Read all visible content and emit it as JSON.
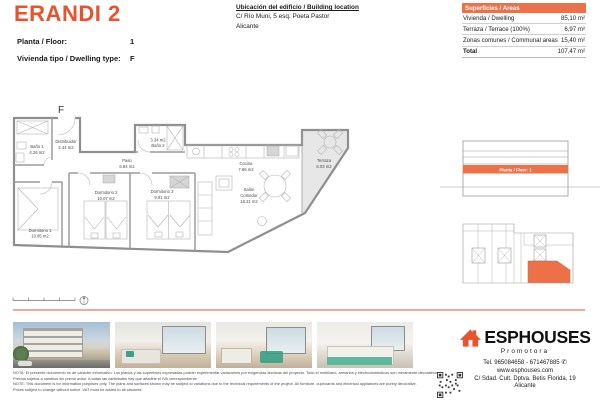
{
  "colors": {
    "accent": "#E8532D",
    "accent_mid": "#ED7148"
  },
  "header": {
    "title": "ERANDI 2",
    "meta": [
      {
        "label": "Planta / Floor:",
        "value": "1"
      },
      {
        "label": "Vivienda tipo / Dwelling type:",
        "value": "F"
      }
    ],
    "location": {
      "title": "Ubicación del edificio / Building location",
      "address": "C/ Río Muni, 5 esq. Poeta Pastor",
      "city": "Alicante"
    },
    "areas": {
      "title": "Superficies / Areas",
      "rows": [
        {
          "label": "Vivienda / Dwelling",
          "value": "85,10 m²"
        },
        {
          "label": "Terraza / Terrace (100%)",
          "value": "6,97 m²"
        },
        {
          "label": "Zonas comunes / Communal areas",
          "value": "15,40 m²"
        }
      ],
      "total": {
        "label": "Total",
        "value": "107,47 m²"
      }
    }
  },
  "plan": {
    "type_label": "F",
    "elevation_floor_label": "Planta / Floor: 1",
    "rooms": [
      {
        "line1": "Baño 1",
        "line2": "4.26 m2"
      },
      {
        "line1": "Distribuidor",
        "line2": "2.44 m2"
      },
      {
        "line1": "Paso",
        "line2": "6.84 m2"
      },
      {
        "line1": "3.34 m2",
        "line2": "Baño 2"
      },
      {
        "line1": "Cocina",
        "line2": "7.86 m2"
      },
      {
        "line1": "Salón",
        "line2": "Comedor",
        "line3": "16.21 m2"
      },
      {
        "line1": "Terraza",
        "line2": "6.03 m2"
      },
      {
        "line1": "Dormitorio 2",
        "line2": "10.07 m2"
      },
      {
        "line1": "Dormitorio 3",
        "line2": "9.91 m2"
      },
      {
        "line1": "Dormitorio 1",
        "line2": "10.85 m2"
      }
    ]
  },
  "footer": {
    "disclaimer": [
      "NOTA: El presente documento es de carácter informativo. Los planos y las superficies expresadas podrán experimentar variaciones por exigencias técnicas del proyecto. Todo el mobiliario, armarios y electrodomésticos son meramente decorativos.",
      "Precios sujetos a cambios sin previo aviso. A todas las cantidades hay que añadirle el IVA correspondiente.",
      "NOTE: This document is for information purposes only. The plans and surfaces shown may be subject to variations due to the technical requirements of the project. All furniture, cupboards and electrical appliances are purely decorative.",
      "Prices subject to change without notice. VAT must be added to all amounts."
    ],
    "brand": {
      "name": "ESPHOUSES",
      "tagline": "Promotora",
      "phone": "Tel. 965084658 - 671467885",
      "website": "www.esphouses.com",
      "address": "C/ Sdad. Cult. Dptva. Betis Florida, 19",
      "city": "Alicante"
    },
    "photos": [
      "building-exterior",
      "living-room",
      "dining-area",
      "bedroom"
    ]
  }
}
